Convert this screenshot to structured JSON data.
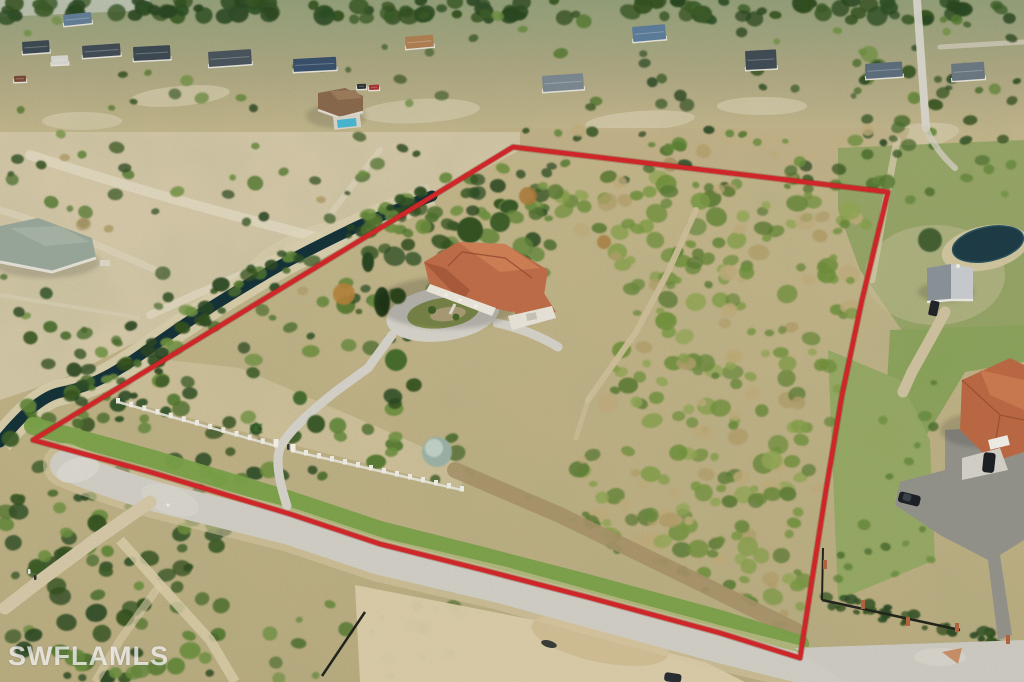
{
  "scene": {
    "type": "aerial-drone-photograph",
    "description": "Aerial view of a large residential acreage lot outlined in red, containing a tile-roof house with a circular driveway, a white front fence, a winding canal, dense scrub, surrounding streets, neighboring homes, a small pond and outbuilding",
    "boundary_color": "#d4282a"
  },
  "watermark": {
    "text": "SWFLAMLS"
  }
}
